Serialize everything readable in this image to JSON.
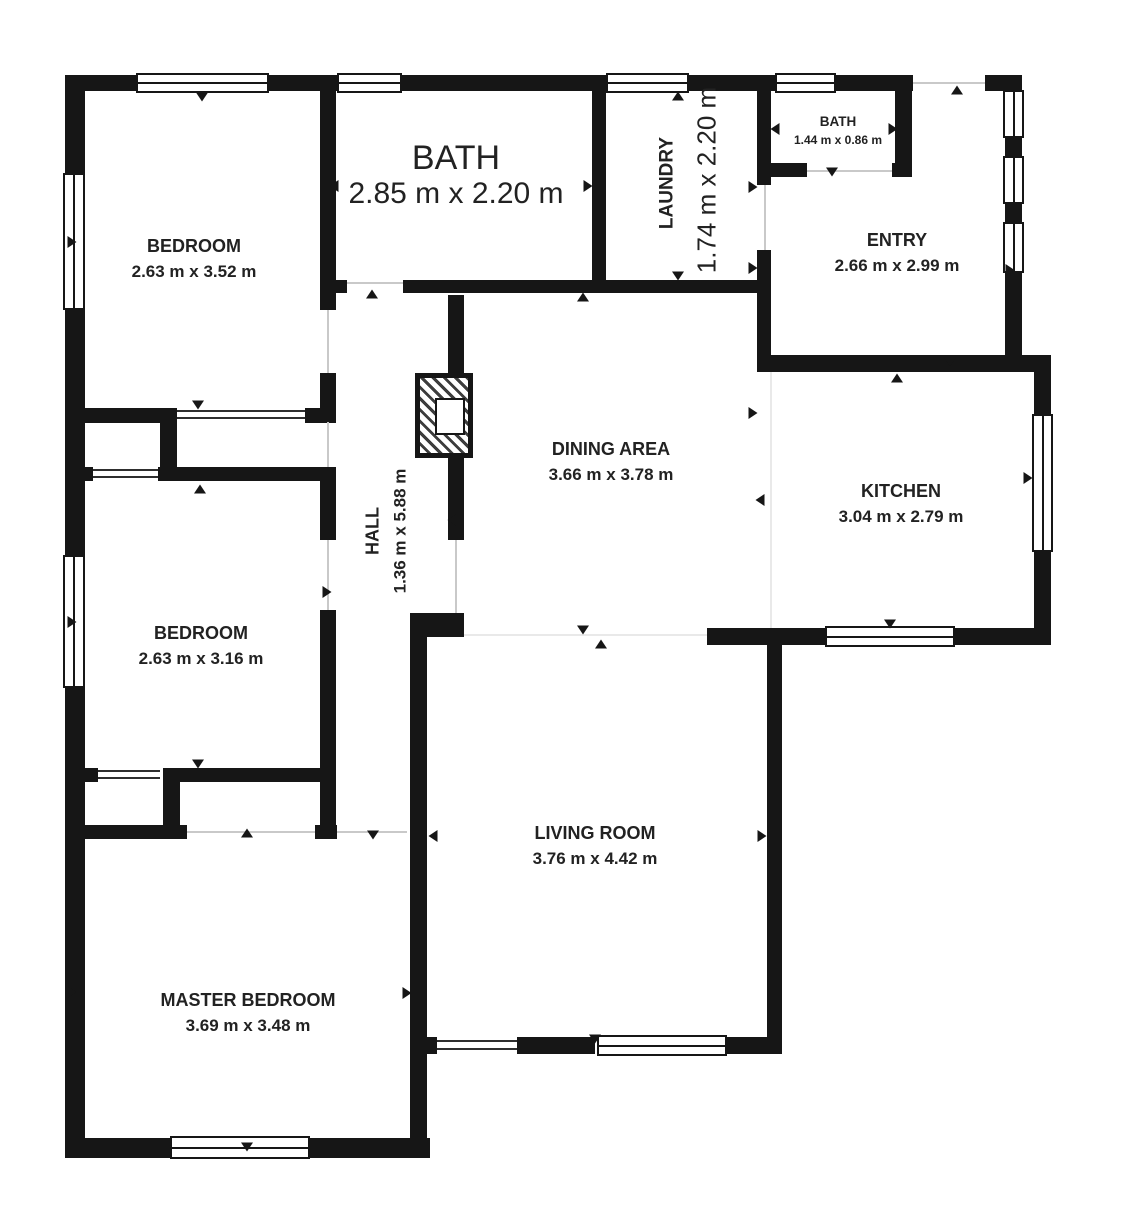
{
  "title": "Apartment floor plan",
  "colors": {
    "wall": "#161616",
    "text": "#222222",
    "opening": "#c9c9c9",
    "faint": "#e9e9e9"
  },
  "rooms": [
    {
      "id": "bedroom-1",
      "name": "BEDROOM",
      "dims": "2.63 m x 3.52 m"
    },
    {
      "id": "bath-main",
      "name": "BATH",
      "dims": "2.85 m x 2.20 m"
    },
    {
      "id": "laundry",
      "name": "LAUNDRY",
      "dims": "1.74 m x 2.20 m"
    },
    {
      "id": "bath-small",
      "name": "BATH",
      "dims": "1.44 m x 0.86 m"
    },
    {
      "id": "entry",
      "name": "ENTRY",
      "dims": "2.66 m x 2.99 m"
    },
    {
      "id": "dining-area",
      "name": "DINING AREA",
      "dims": "3.66 m x 3.78 m"
    },
    {
      "id": "kitchen",
      "name": "KITCHEN",
      "dims": "3.04 m x 2.79 m"
    },
    {
      "id": "hall",
      "name": "HALL",
      "dims": "1.36 m x 5.88 m"
    },
    {
      "id": "bedroom-2",
      "name": "BEDROOM",
      "dims": "2.63 m x 3.16 m"
    },
    {
      "id": "living-room",
      "name": "LIVING ROOM",
      "dims": "3.76 m x 4.42 m"
    },
    {
      "id": "master-bedroom",
      "name": "MASTER BEDROOM",
      "dims": "3.69 m x 3.48 m"
    }
  ]
}
